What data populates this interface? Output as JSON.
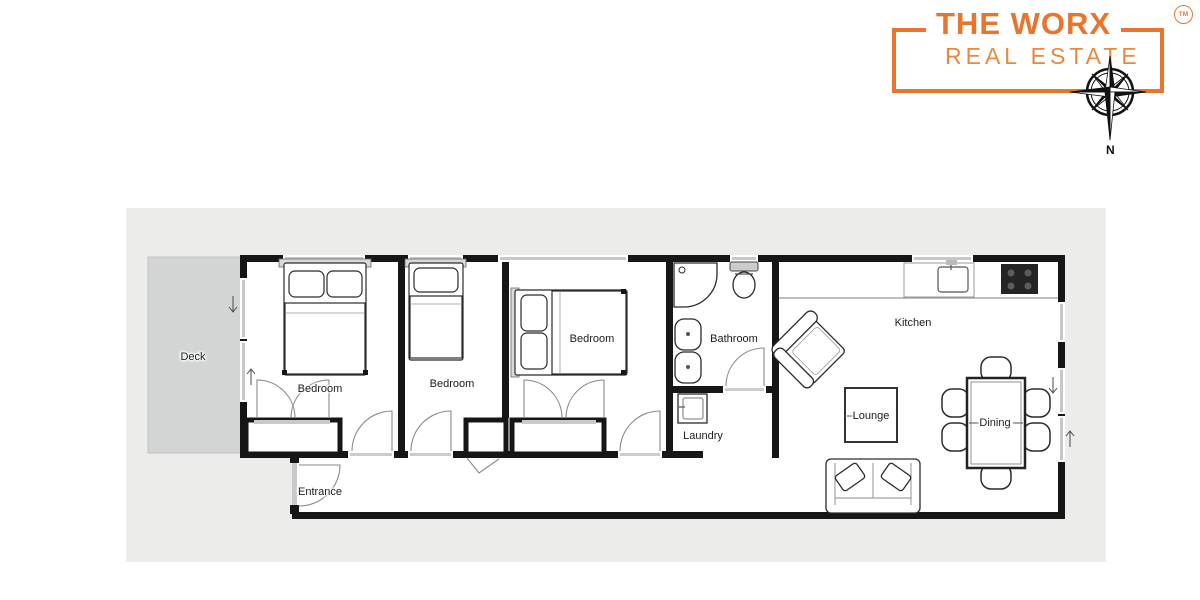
{
  "logo": {
    "title": "THE WORX",
    "subtitle": "REAL ESTATE",
    "trademark": "TM",
    "accent_color": "#E8752E",
    "subtitle_color": "#E98940",
    "compass": {
      "north_label": "N"
    }
  },
  "floorplan": {
    "colors": {
      "panel": "#ECECEA",
      "deck": "#D3D5D5",
      "wall": "#161616",
      "window": "#C6C8C8",
      "door_arc": "#8a8a8a"
    },
    "rooms": [
      {
        "id": "deck",
        "label": "Deck"
      },
      {
        "id": "bedroom-1",
        "label": "Bedroom"
      },
      {
        "id": "bedroom-2",
        "label": "Bedroom"
      },
      {
        "id": "bedroom-3",
        "label": "Bedroom"
      },
      {
        "id": "bathroom",
        "label": "Bathroom"
      },
      {
        "id": "laundry",
        "label": "Laundry"
      },
      {
        "id": "entrance",
        "label": "Entrance"
      },
      {
        "id": "kitchen",
        "label": "Kitchen"
      },
      {
        "id": "lounge",
        "label": "Lounge"
      },
      {
        "id": "dining",
        "label": "Dining"
      }
    ]
  }
}
